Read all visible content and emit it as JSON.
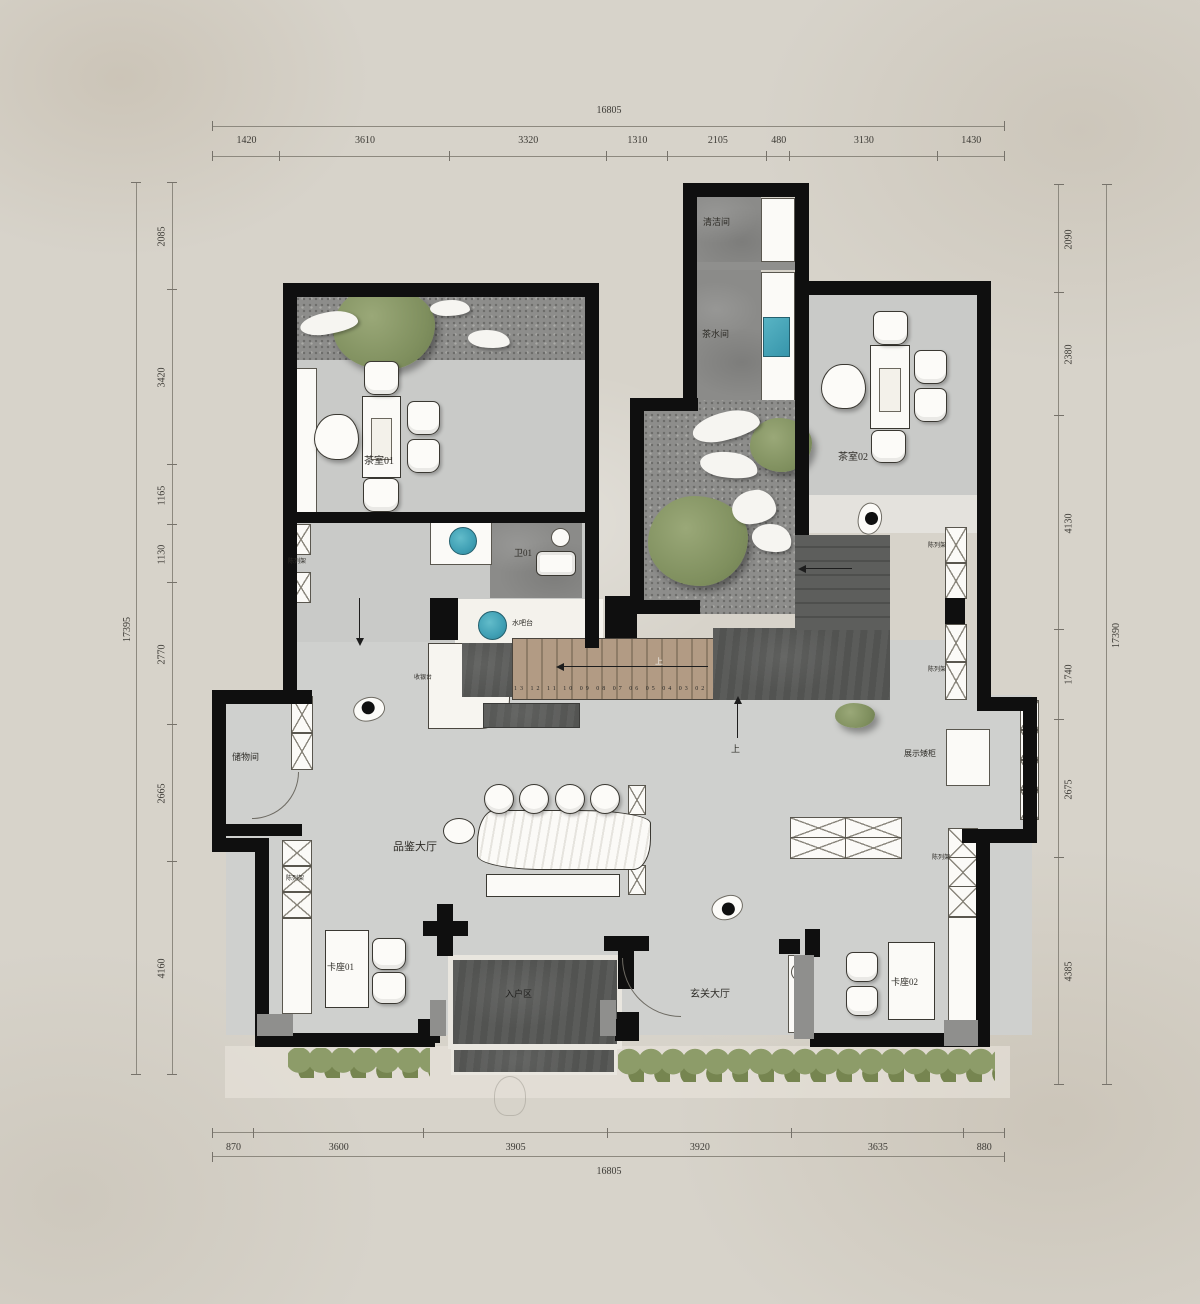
{
  "dims": {
    "top": {
      "total": "16805",
      "segments": [
        "1420",
        "3610",
        "3320",
        "1310",
        "2105",
        "480",
        "3130",
        "1430"
      ]
    },
    "bottom": {
      "total": "16805",
      "segments": [
        "870",
        "3600",
        "3905",
        "3920",
        "3635",
        "880"
      ]
    },
    "left": {
      "total": "17395",
      "segments": [
        "2085",
        "3420",
        "1165",
        "1130",
        "2770",
        "2665",
        "4160"
      ]
    },
    "right": {
      "total": "17390",
      "segments": [
        "2090",
        "2380",
        "4130",
        "1740",
        "2675",
        "4385"
      ]
    }
  },
  "rooms": {
    "cleaning": "清洁间",
    "tea_pantry": "茶水间",
    "tea_room_01": "茶室01",
    "tea_room_02": "茶室02",
    "wc_01": "卫01",
    "water_bar": "水吧台",
    "cashier": "收银台",
    "storage": "储物间",
    "tasting_hall": "品鉴大厅",
    "booth_01": "卡座01",
    "booth_02": "卡座02",
    "entry_area": "入户区",
    "foyer_hall": "玄关大厅",
    "display_cabinet": "展示矮柜",
    "display_shelf": "陈列架",
    "up": "上"
  },
  "stairs": {
    "tread_numbers": "13 12 11 10 09 08 07 06 05 04 03 02"
  },
  "colors": {
    "wall": "#0f0f0f",
    "hall_floor": "#cfd0ce",
    "slate": "#525351",
    "wood": "#b29b84",
    "sink_teal": "#3f9fb4",
    "plant_green": "#7f8f5e",
    "paper": "#d7d3ca"
  }
}
